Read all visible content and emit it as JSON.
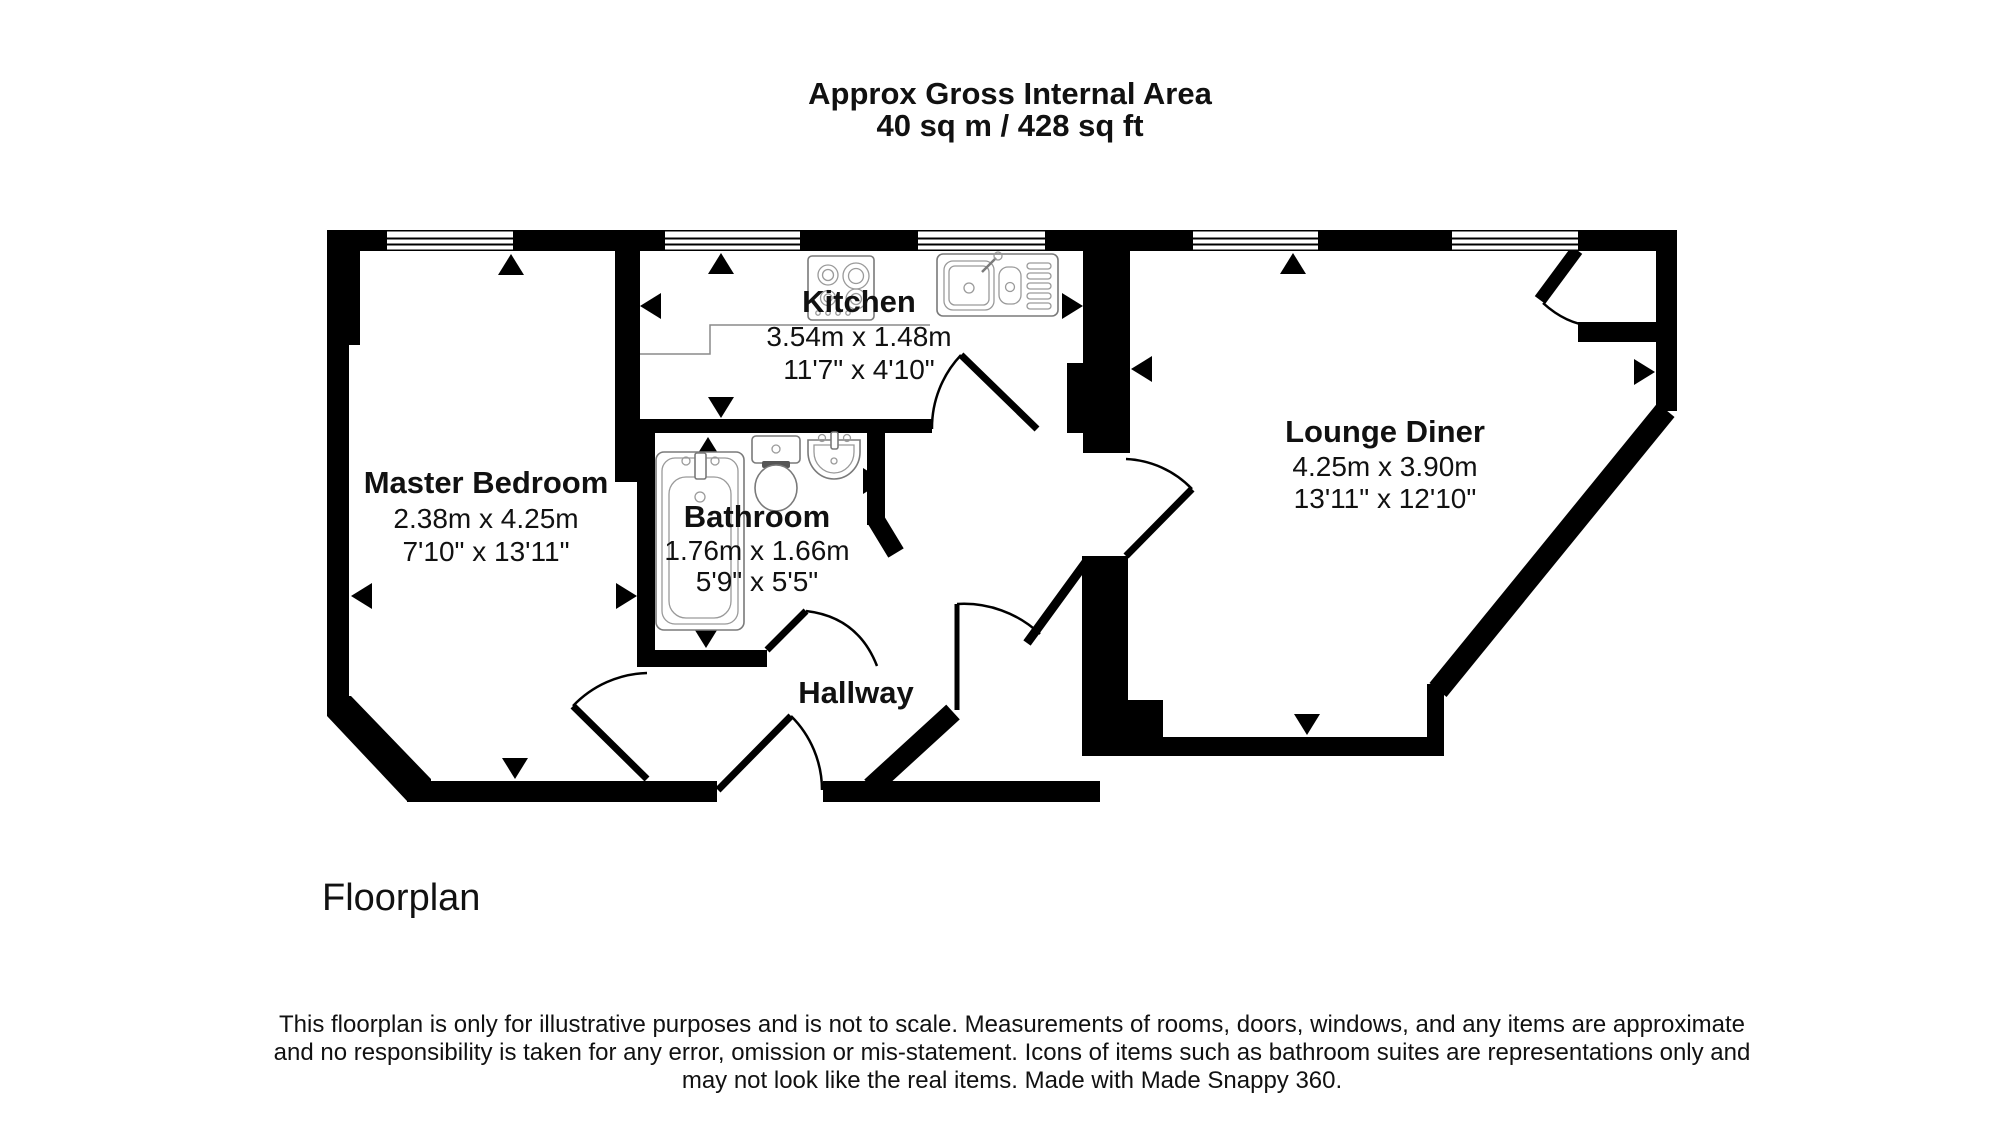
{
  "title": {
    "line1": "Approx Gross Internal Area",
    "line2": "40 sq m / 428 sq ft"
  },
  "rooms": {
    "master_bedroom": {
      "name": "Master Bedroom",
      "size_metric": "2.38m x 4.25m",
      "size_imperial": "7'10\" x 13'11\""
    },
    "kitchen": {
      "name": "Kitchen",
      "size_metric": "3.54m x 1.48m",
      "size_imperial": "11'7\" x 4'10\""
    },
    "bathroom": {
      "name": "Bathroom",
      "size_metric": "1.76m x 1.66m",
      "size_imperial": "5'9\" x 5'5\""
    },
    "lounge_diner": {
      "name": "Lounge Diner",
      "size_metric": "4.25m x 3.90m",
      "size_imperial": "13'11\" x 12'10\""
    },
    "hallway": {
      "name": "Hallway"
    }
  },
  "caption": "Floorplan",
  "disclaimer": {
    "line1": "This floorplan is only for illustrative purposes and is not to scale. Measurements of rooms, doors, windows, and any items are approximate",
    "line2": "and no responsibility is taken for any error, omission or mis-statement. Icons of items such as bathroom suites are representations only and",
    "line3": "may not look like the real items. Made with Made Snappy 360."
  },
  "colors": {
    "wall": "#000000",
    "background": "#ffffff",
    "fixture_stroke": "#7a7a7a"
  }
}
